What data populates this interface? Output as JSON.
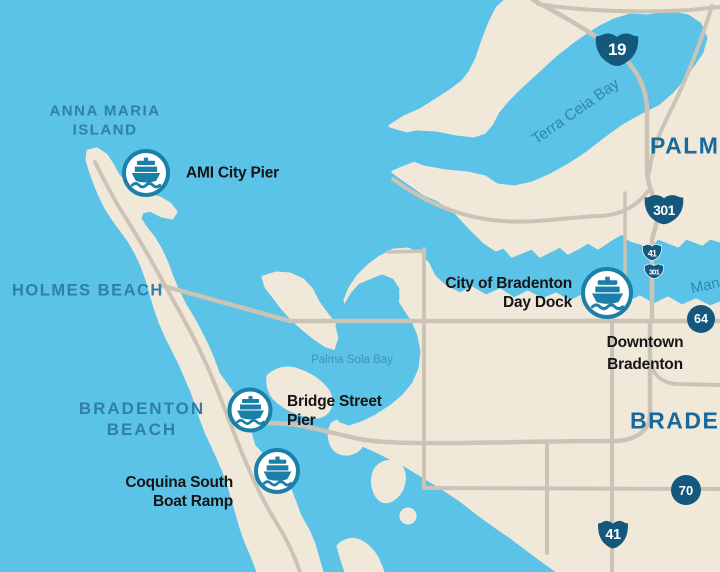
{
  "colors": {
    "water": "#5BC2E8",
    "land": "#F0E9DA",
    "road": "#CBC4B6",
    "marker_blue": "#1B80A8",
    "shield_navy": "#14587E",
    "beach_label_blue": "#2F7FA9",
    "city_label_blue": "#176A9B",
    "bay_label_blue": "#2F87B0",
    "poi_label_black": "#151515"
  },
  "areas": {
    "anna_maria_island_line1": "ANNA MARIA",
    "anna_maria_island_line2": "ISLAND",
    "holmes_beach": "HOLMES BEACH",
    "bradenton_beach_line1": "BRADENTON",
    "bradenton_beach_line2": "BEACH",
    "palmetto": "PALMETTO",
    "bradenton": "BRADENTON",
    "downtown_line1": "Downtown",
    "downtown_line2": "Bradenton"
  },
  "water_bodies": {
    "terra_ceia_bay": "Terra Ceia Bay",
    "palma_sola_bay": "Palma Sola Bay",
    "manatee_river": "Manatee River"
  },
  "markers": [
    {
      "id": "ami-city-pier",
      "label": "AMI City Pier"
    },
    {
      "id": "city-of-bradenton-day-dock",
      "label_line1": "City of Bradenton",
      "label_line2": "Day Dock"
    },
    {
      "id": "bridge-street-pier",
      "label_line1": "Bridge Street",
      "label_line2": "Pier"
    },
    {
      "id": "coquina-south-boat-ramp",
      "label_line1": "Coquina South",
      "label_line2": "Boat Ramp"
    }
  ],
  "route_shields": [
    {
      "type": "us-shield",
      "number": "19"
    },
    {
      "type": "us-shield",
      "number": "301"
    },
    {
      "type": "us-shield-small",
      "number": "41"
    },
    {
      "type": "us-shield-small",
      "number": "301"
    },
    {
      "type": "circle-shield",
      "number": "64"
    },
    {
      "type": "circle-shield",
      "number": "70"
    },
    {
      "type": "us-shield",
      "number": "41"
    }
  ]
}
